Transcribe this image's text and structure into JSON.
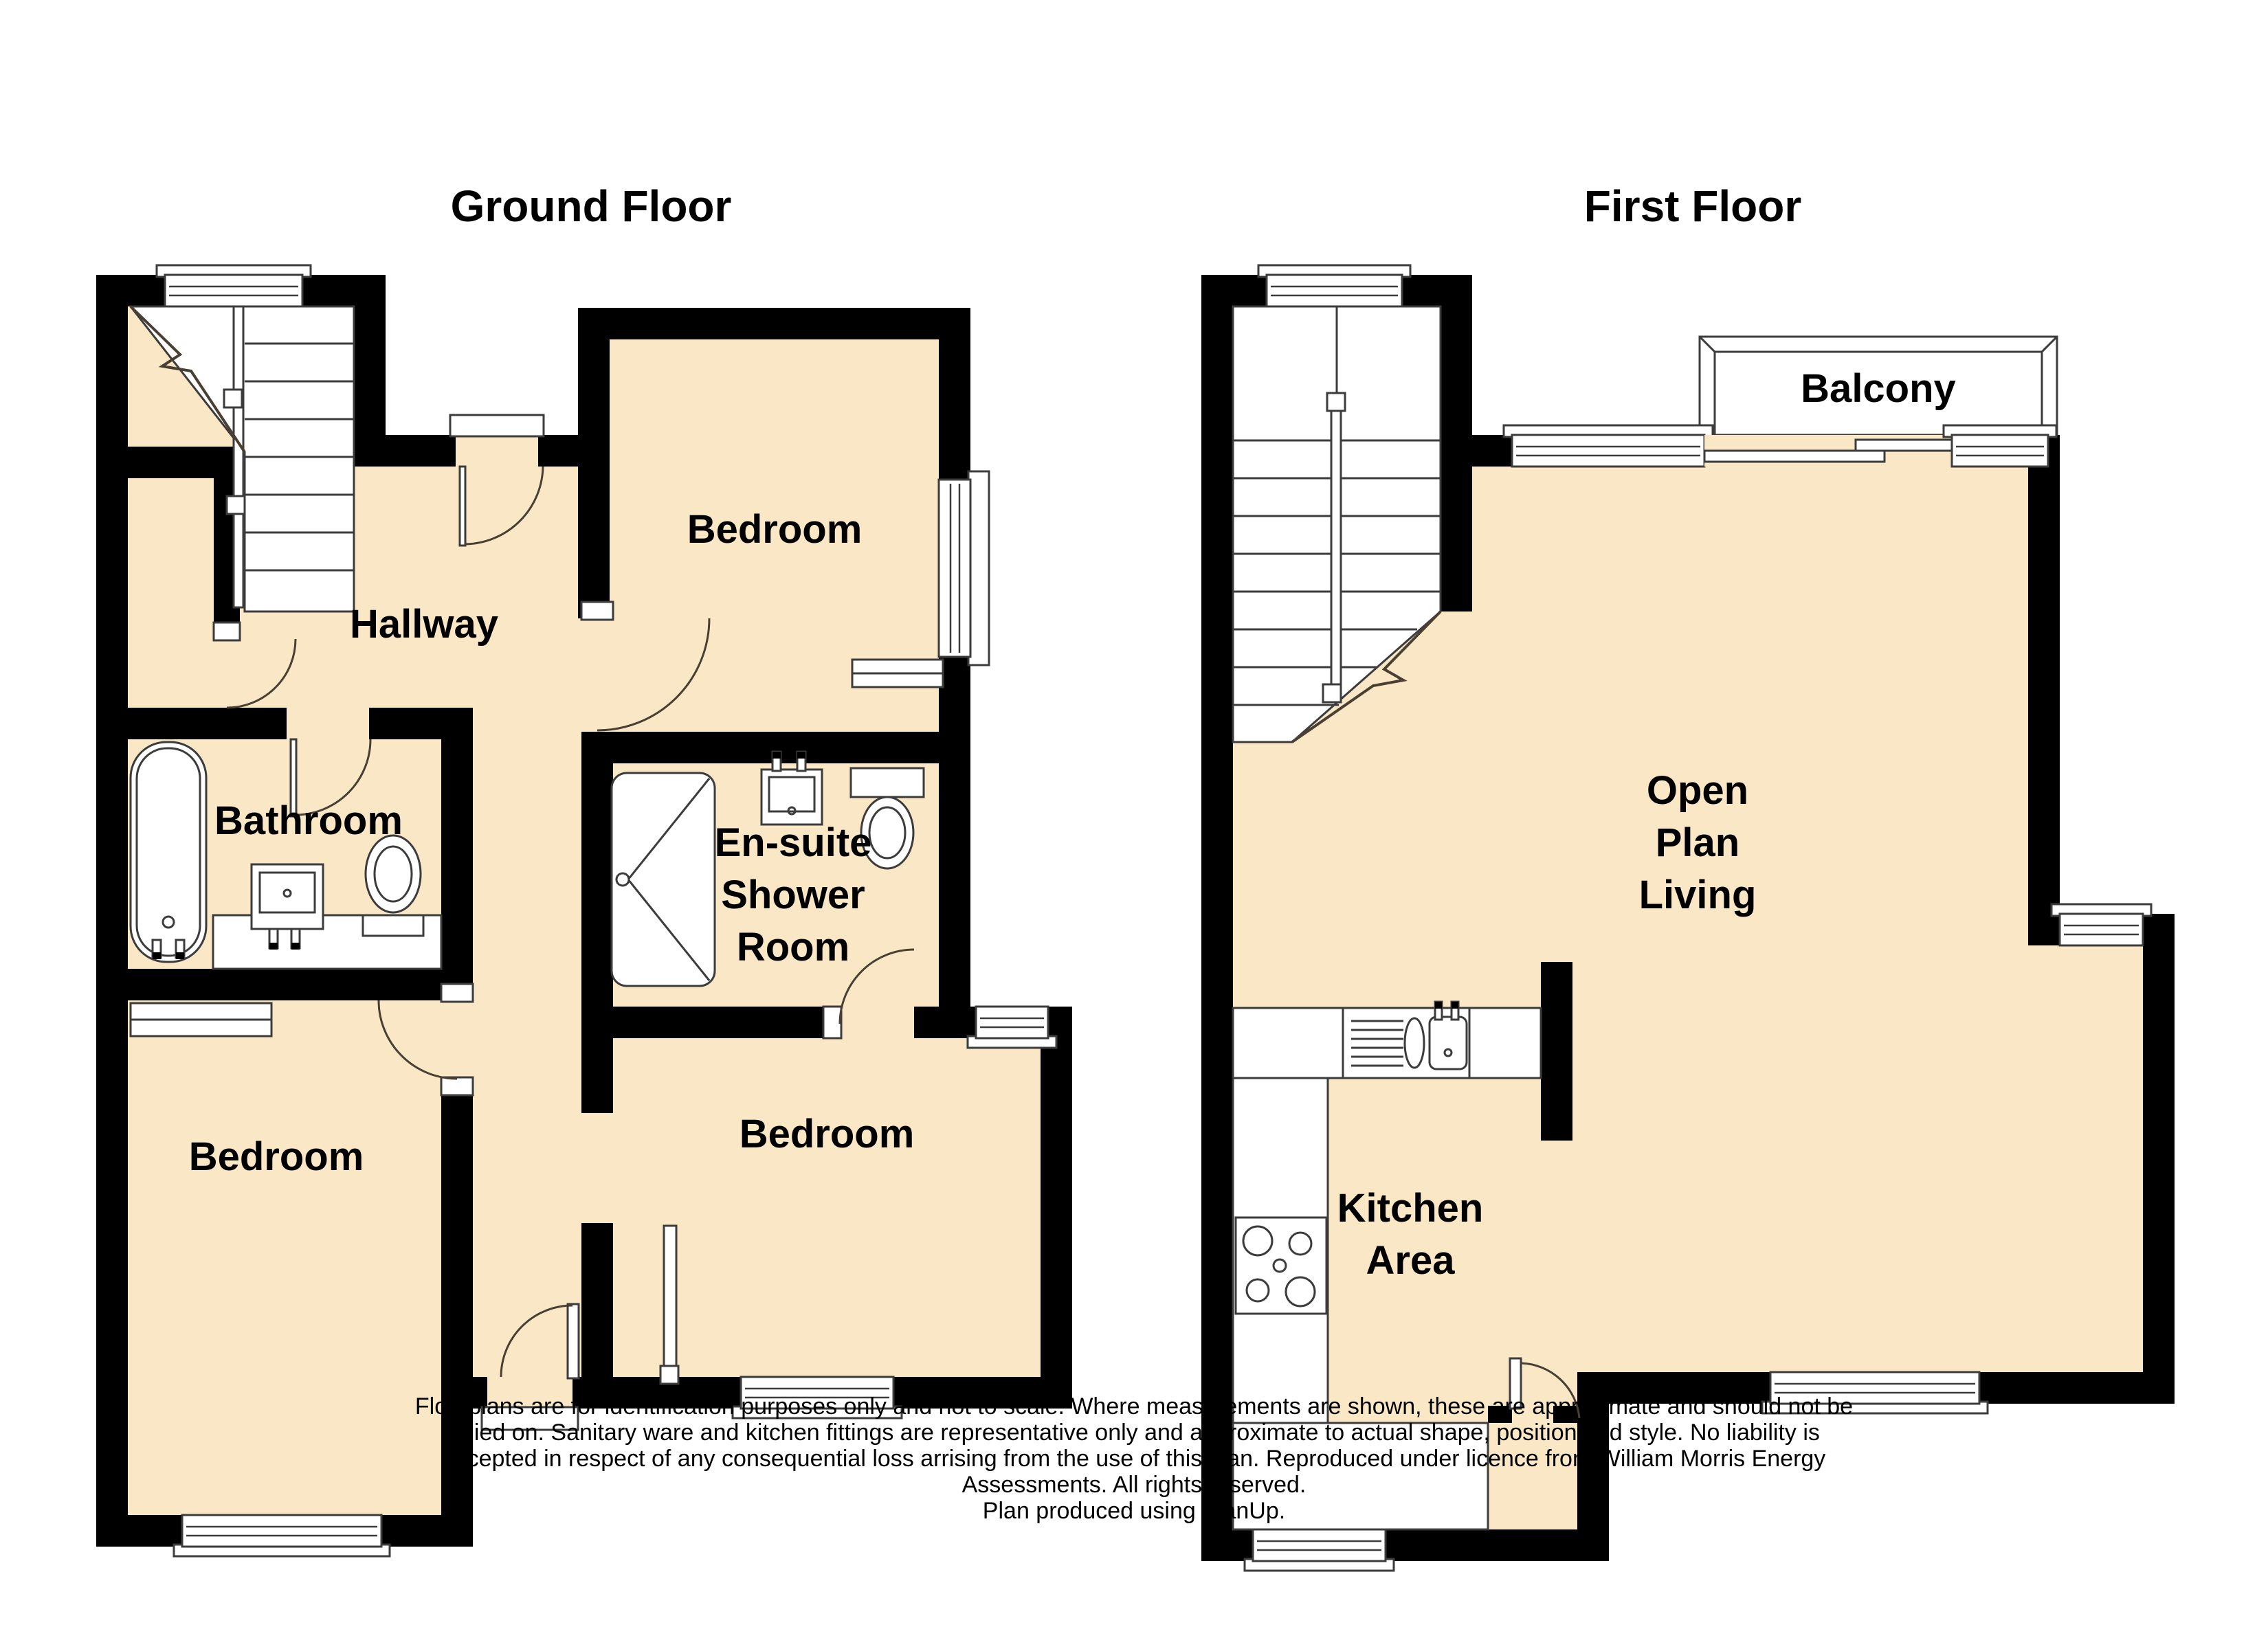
{
  "colors": {
    "floor_fill": "#FAE7C6",
    "wall": "#000000",
    "background": "#ffffff"
  },
  "ground_floor": {
    "title": "Ground Floor",
    "rooms": {
      "bedroom_top": "Bedroom",
      "hallway": "Hallway",
      "bathroom": "Bathroom",
      "ensuite_line1": "En-suite",
      "ensuite_line2": "Shower",
      "ensuite_line3": "Room",
      "bedroom_bottom_left": "Bedroom",
      "bedroom_bottom_right": "Bedroom"
    }
  },
  "first_floor": {
    "title": "First Floor",
    "rooms": {
      "balcony": "Balcony",
      "open_plan_line1": "Open",
      "open_plan_line2": "Plan",
      "open_plan_line3": "Living",
      "kitchen_line1": "Kitchen",
      "kitchen_line2": "Area"
    }
  },
  "disclaimer": {
    "lines": [
      "Floorplans are for identification purposes only and not to scale. Where measurements are shown, these are approximate and should not be",
      "relied on. Sanitary ware and kitchen fittings are representative only and approximate to actual shape, position and style. No liability is",
      "accepted in respect of any consequential loss arrising from the use of this plan. Reproduced under licence from William Morris Energy",
      "Assessments. All rights reserved.",
      "Plan produced using PlanUp."
    ]
  }
}
